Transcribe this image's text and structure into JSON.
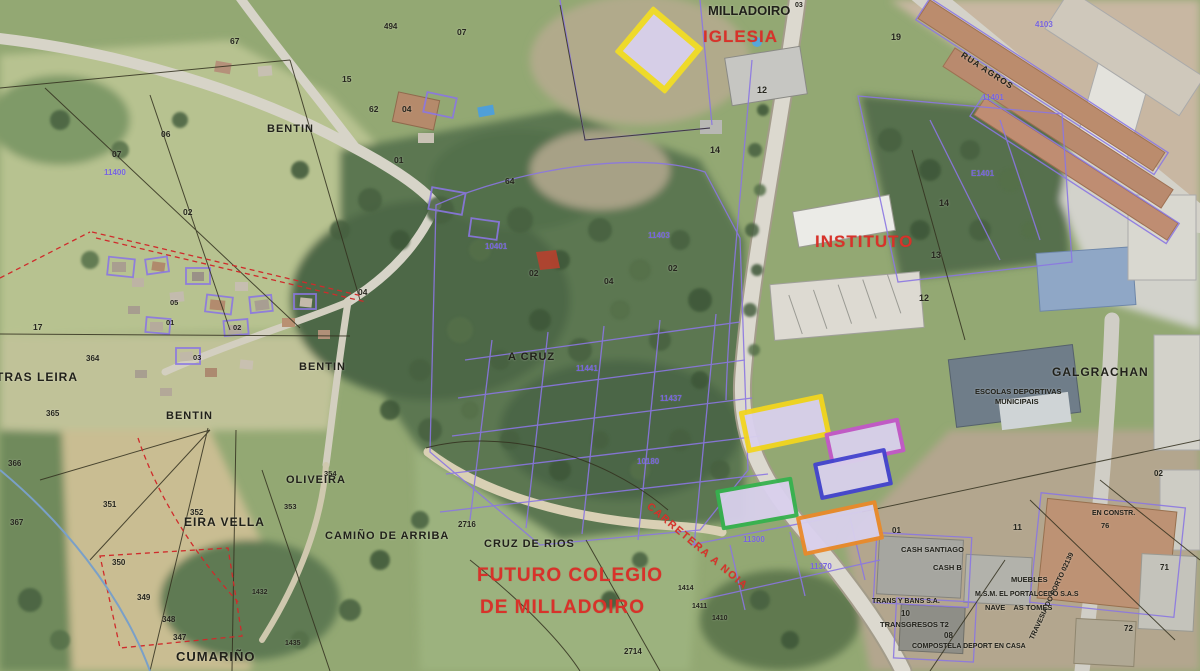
{
  "map": {
    "description": "Aerial cadastral map of Milladoiro with highlighted candidate parcels",
    "colors": {
      "highlight_fill": "#d9d0ec",
      "yellow": "#f2dd25",
      "magenta": "#c257c9",
      "blue": "#4343cf",
      "green": "#35b14f",
      "orange": "#e98a2b",
      "red_annotation": "#d8322a",
      "cadastral_purple": "#8b77e2"
    }
  },
  "highlight_parcels": [
    {
      "name": "highlighted-parcel-iglesia",
      "color": "#f2dd25",
      "fill": "#d9d0ec",
      "x": 626,
      "y": 20,
      "w": 54,
      "h": 48,
      "rot": 40,
      "bw": 6
    },
    {
      "name": "highlighted-parcel-yellow",
      "color": "#f2d51f",
      "fill": "#d9d0ec",
      "x": 742,
      "y": 402,
      "w": 76,
      "h": 33,
      "rot": -12,
      "bw": 5
    },
    {
      "name": "highlighted-parcel-magenta",
      "color": "#c257c9",
      "fill": "#d9d0ec",
      "x": 827,
      "y": 425,
      "w": 68,
      "h": 27,
      "rot": -12,
      "bw": 4
    },
    {
      "name": "highlighted-parcel-blue",
      "color": "#4343cf",
      "fill": "#d9d0ec",
      "x": 816,
      "y": 455,
      "w": 66,
      "h": 30,
      "rot": -12,
      "bw": 4
    },
    {
      "name": "highlighted-parcel-green",
      "color": "#35b14f",
      "fill": "#d9d0ec",
      "x": 718,
      "y": 483,
      "w": 70,
      "h": 33,
      "rot": -10,
      "bw": 4
    },
    {
      "name": "highlighted-parcel-orange",
      "color": "#e98a2b",
      "fill": "#d9d0ec",
      "x": 799,
      "y": 508,
      "w": 74,
      "h": 32,
      "rot": -12,
      "bw": 4
    }
  ],
  "labels": [
    {
      "name": "iglesia-label",
      "text": "IGLESIA",
      "x": 703,
      "y": 28,
      "cls": "red",
      "size": 17,
      "ls": 1
    },
    {
      "name": "instituto-label",
      "text": "INSTITUTO",
      "x": 815,
      "y": 233,
      "cls": "red",
      "size": 17,
      "ls": 1
    },
    {
      "name": "futuro-colegio-line1",
      "text": "FUTURO COLEGIO",
      "x": 477,
      "y": 566,
      "cls": "red",
      "size": 19,
      "ls": 1
    },
    {
      "name": "futuro-colegio-line2",
      "text": "DE MILLADOIRO",
      "x": 480,
      "y": 598,
      "cls": "red",
      "size": 19,
      "ls": 1
    },
    {
      "name": "carretera-road-label",
      "text": "CARRETERA A NOIA",
      "x": 648,
      "y": 500,
      "cls": "red",
      "size": 10.5,
      "rot": 40,
      "ls": 1.5
    },
    {
      "name": "milladoiro-label",
      "text": "MILLADOIRO",
      "x": 708,
      "y": 4,
      "cls": "black",
      "size": 13
    },
    {
      "name": "milladoiro-superscript",
      "text": "03",
      "x": 795,
      "y": 2,
      "cls": "black",
      "size": 7
    },
    {
      "name": "bentin-north-label",
      "text": "BENTIN",
      "x": 267,
      "y": 124,
      "cls": "black",
      "size": 11,
      "ls": 1
    },
    {
      "name": "bentin-mid-label",
      "text": "BENTIN",
      "x": 299,
      "y": 362,
      "cls": "black",
      "size": 11,
      "ls": 1
    },
    {
      "name": "bentin-south-label",
      "text": "BENTIN",
      "x": 166,
      "y": 411,
      "cls": "black",
      "size": 11,
      "ls": 1
    },
    {
      "name": "tras-leira-label",
      "text": "TRAS LEIRA",
      "x": -4,
      "y": 371,
      "cls": "black",
      "size": 12,
      "ls": 1
    },
    {
      "name": "eira-vella-label",
      "text": "EIRA VELLA",
      "x": 184,
      "y": 516,
      "cls": "black",
      "size": 12,
      "ls": 1
    },
    {
      "name": "oliveira-label",
      "text": "OLIVEIRA",
      "x": 286,
      "y": 475,
      "cls": "black",
      "size": 11,
      "ls": 1
    },
    {
      "name": "camino-de-arriba-label",
      "text": "CAMIÑO DE ARRIBA",
      "x": 325,
      "y": 531,
      "cls": "black",
      "size": 11,
      "ls": 1
    },
    {
      "name": "cruz-de-rios-label",
      "text": "CRUZ DE RIOS",
      "x": 484,
      "y": 539,
      "cls": "black",
      "size": 11,
      "ls": 1
    },
    {
      "name": "a-cruz-label",
      "text": "A CRUZ",
      "x": 508,
      "y": 352,
      "cls": "black",
      "size": 11,
      "ls": 1
    },
    {
      "name": "galgrachan-label",
      "text": "GALGRACHAN",
      "x": 1052,
      "y": 366,
      "cls": "black",
      "size": 12,
      "ls": 1
    },
    {
      "name": "escolas-deportivas-line1",
      "text": "ESCOLAS DEPORTIVAS",
      "x": 975,
      "y": 388,
      "cls": "black",
      "size": 7.5
    },
    {
      "name": "escolas-deportivas-line2",
      "text": "MUNICIPAIS",
      "x": 995,
      "y": 398,
      "cls": "black",
      "size": 7.5
    },
    {
      "name": "cumarino-label",
      "text": "CUMARIÑO",
      "x": 176,
      "y": 650,
      "cls": "black",
      "size": 13,
      "ls": 1
    },
    {
      "name": "cash-santiago-label",
      "text": "CASH SANTIAGO",
      "x": 901,
      "y": 546,
      "cls": "black",
      "size": 7.5
    },
    {
      "name": "cash-b-label",
      "text": "CASH B",
      "x": 933,
      "y": 564,
      "cls": "black",
      "size": 7.5
    },
    {
      "name": "muebles-label",
      "text": "MUEBLES",
      "x": 1011,
      "y": 576,
      "cls": "black",
      "size": 7.5
    },
    {
      "name": "portalcedo-label",
      "text": "M.S.M. EL PORTALCEDO S.A.S",
      "x": 975,
      "y": 591,
      "cls": "black",
      "size": 7
    },
    {
      "name": "nave-as-tomes-label",
      "text": "NAVE    AS TOMES",
      "x": 985,
      "y": 604,
      "cls": "black",
      "size": 7.5
    },
    {
      "name": "trans-y-bans-label",
      "text": "TRANS Y BANS S.A.",
      "x": 872,
      "y": 598,
      "cls": "black",
      "size": 7
    },
    {
      "name": "transgresos-label",
      "text": "TRANSGRESOS T2",
      "x": 880,
      "y": 621,
      "cls": "black",
      "size": 7.5
    },
    {
      "name": "compostela-deport-label",
      "text": "COMPOSTELA DEPORT EN CASA",
      "x": 912,
      "y": 643,
      "cls": "black",
      "size": 7
    },
    {
      "name": "travesia-road-label",
      "text": "TRAVESIA DO PORTO 02139",
      "x": 1032,
      "y": 636,
      "cls": "black",
      "size": 7,
      "rot": -65
    },
    {
      "name": "en-constr-label",
      "text": "EN CONSTR.",
      "x": 1092,
      "y": 510,
      "cls": "black",
      "size": 7
    },
    {
      "name": "parcel-number",
      "text": "76",
      "x": 1101,
      "y": 522,
      "cls": "num",
      "size": 7.5
    },
    {
      "name": "rua-agros-road-label",
      "text": "RUA AGROS",
      "x": 962,
      "y": 50,
      "cls": "black",
      "size": 8.5,
      "rot": 33,
      "ls": 1
    },
    {
      "name": "parcel-number",
      "text": "01",
      "x": 394,
      "y": 156,
      "cls": "num",
      "size": 8.5
    },
    {
      "name": "parcel-number",
      "text": "02",
      "x": 183,
      "y": 208,
      "cls": "num",
      "size": 8.5
    },
    {
      "name": "parcel-number",
      "text": "17",
      "x": 33,
      "y": 323,
      "cls": "num",
      "size": 8.5
    },
    {
      "name": "parcel-number",
      "text": "07",
      "x": 112,
      "y": 150,
      "cls": "num",
      "size": 8.5
    },
    {
      "name": "parcel-number",
      "text": "06",
      "x": 161,
      "y": 130,
      "cls": "num",
      "size": 8.5
    },
    {
      "name": "parcel-number",
      "text": "67",
      "x": 230,
      "y": 37,
      "cls": "num",
      "size": 8.5
    },
    {
      "name": "parcel-number",
      "text": "494",
      "x": 384,
      "y": 23,
      "cls": "num",
      "size": 8
    },
    {
      "name": "parcel-number",
      "text": "07",
      "x": 457,
      "y": 28,
      "cls": "num",
      "size": 8.5
    },
    {
      "name": "parcel-number",
      "text": "15",
      "x": 342,
      "y": 75,
      "cls": "num",
      "size": 8.5
    },
    {
      "name": "parcel-number",
      "text": "62",
      "x": 369,
      "y": 105,
      "cls": "num",
      "size": 8.5
    },
    {
      "name": "parcel-number",
      "text": "04",
      "x": 402,
      "y": 105,
      "cls": "num",
      "size": 8.5
    },
    {
      "name": "parcel-number",
      "text": "64",
      "x": 505,
      "y": 177,
      "cls": "num",
      "size": 8.5
    },
    {
      "name": "parcel-number",
      "text": "04",
      "x": 358,
      "y": 288,
      "cls": "num",
      "size": 8.5
    },
    {
      "name": "parcel-number",
      "text": "01",
      "x": 166,
      "y": 319,
      "cls": "num",
      "size": 7.5
    },
    {
      "name": "parcel-number",
      "text": "02",
      "x": 233,
      "y": 324,
      "cls": "num",
      "size": 7.5
    },
    {
      "name": "parcel-number",
      "text": "03",
      "x": 193,
      "y": 354,
      "cls": "num",
      "size": 7.5
    },
    {
      "name": "parcel-number",
      "text": "05",
      "x": 170,
      "y": 299,
      "cls": "num",
      "size": 7.5
    },
    {
      "name": "parcel-number",
      "text": "02",
      "x": 529,
      "y": 269,
      "cls": "num",
      "size": 8.5
    },
    {
      "name": "parcel-number",
      "text": "04",
      "x": 604,
      "y": 277,
      "cls": "num",
      "size": 8.5
    },
    {
      "name": "parcel-number",
      "text": "02",
      "x": 668,
      "y": 264,
      "cls": "num",
      "size": 8.5
    },
    {
      "name": "parcel-number",
      "text": "12",
      "x": 757,
      "y": 86,
      "cls": "num",
      "size": 9
    },
    {
      "name": "parcel-number",
      "text": "14",
      "x": 710,
      "y": 146,
      "cls": "num",
      "size": 9
    },
    {
      "name": "parcel-number",
      "text": "19",
      "x": 891,
      "y": 33,
      "cls": "num",
      "size": 9
    },
    {
      "name": "parcel-number",
      "text": "14",
      "x": 939,
      "y": 199,
      "cls": "num",
      "size": 9
    },
    {
      "name": "parcel-number",
      "text": "13",
      "x": 931,
      "y": 251,
      "cls": "num",
      "size": 9
    },
    {
      "name": "parcel-number",
      "text": "12",
      "x": 919,
      "y": 294,
      "cls": "num",
      "size": 9
    },
    {
      "name": "parcel-number",
      "text": "364",
      "x": 86,
      "y": 355,
      "cls": "num",
      "size": 8
    },
    {
      "name": "parcel-number",
      "text": "365",
      "x": 46,
      "y": 410,
      "cls": "num",
      "size": 8
    },
    {
      "name": "parcel-number",
      "text": "366",
      "x": 8,
      "y": 460,
      "cls": "num",
      "size": 8
    },
    {
      "name": "parcel-number",
      "text": "367",
      "x": 10,
      "y": 519,
      "cls": "num",
      "size": 8
    },
    {
      "name": "parcel-number",
      "text": "351",
      "x": 103,
      "y": 501,
      "cls": "num",
      "size": 8
    },
    {
      "name": "parcel-number",
      "text": "352",
      "x": 190,
      "y": 509,
      "cls": "num",
      "size": 8
    },
    {
      "name": "parcel-number",
      "text": "350",
      "x": 112,
      "y": 559,
      "cls": "num",
      "size": 8
    },
    {
      "name": "parcel-number",
      "text": "349",
      "x": 137,
      "y": 594,
      "cls": "num",
      "size": 8
    },
    {
      "name": "parcel-number",
      "text": "348",
      "x": 162,
      "y": 616,
      "cls": "num",
      "size": 8
    },
    {
      "name": "parcel-number",
      "text": "347",
      "x": 173,
      "y": 634,
      "cls": "num",
      "size": 8
    },
    {
      "name": "parcel-number",
      "text": "354",
      "x": 324,
      "y": 470,
      "cls": "num",
      "size": 7.5
    },
    {
      "name": "parcel-number",
      "text": "353",
      "x": 284,
      "y": 503,
      "cls": "num",
      "size": 7.5
    },
    {
      "name": "parcel-number",
      "text": "2716",
      "x": 458,
      "y": 521,
      "cls": "num",
      "size": 8
    },
    {
      "name": "parcel-number",
      "text": "2714",
      "x": 624,
      "y": 648,
      "cls": "num",
      "size": 8
    },
    {
      "name": "parcel-number",
      "text": "1414",
      "x": 678,
      "y": 585,
      "cls": "num",
      "size": 7
    },
    {
      "name": "parcel-number",
      "text": "1411",
      "x": 692,
      "y": 603,
      "cls": "num",
      "size": 7
    },
    {
      "name": "parcel-number",
      "text": "1410",
      "x": 712,
      "y": 615,
      "cls": "num",
      "size": 7
    },
    {
      "name": "parcel-number",
      "text": "1432",
      "x": 252,
      "y": 589,
      "cls": "num",
      "size": 7
    },
    {
      "name": "parcel-number",
      "text": "1435",
      "x": 285,
      "y": 640,
      "cls": "num",
      "size": 7
    },
    {
      "name": "parcel-number",
      "text": "11",
      "x": 1013,
      "y": 523,
      "cls": "num",
      "size": 8.5
    },
    {
      "name": "parcel-number",
      "text": "01",
      "x": 892,
      "y": 527,
      "cls": "num",
      "size": 8
    },
    {
      "name": "parcel-number",
      "text": "10",
      "x": 901,
      "y": 610,
      "cls": "num",
      "size": 8
    },
    {
      "name": "parcel-number",
      "text": "08",
      "x": 944,
      "y": 632,
      "cls": "num",
      "size": 8
    },
    {
      "name": "parcel-number",
      "text": "72",
      "x": 1124,
      "y": 625,
      "cls": "num",
      "size": 8
    },
    {
      "name": "parcel-number",
      "text": "71",
      "x": 1160,
      "y": 564,
      "cls": "num",
      "size": 8
    },
    {
      "name": "parcel-number",
      "text": "02",
      "x": 1154,
      "y": 470,
      "cls": "num",
      "size": 8
    },
    {
      "name": "cadastral-ref",
      "text": "11400",
      "x": 104,
      "y": 169,
      "cls": "purple",
      "size": 8
    },
    {
      "name": "cadastral-ref",
      "text": "10401",
      "x": 485,
      "y": 243,
      "cls": "purple",
      "size": 8
    },
    {
      "name": "cadastral-ref",
      "text": "11403",
      "x": 648,
      "y": 232,
      "cls": "purple",
      "size": 8
    },
    {
      "name": "cadastral-ref",
      "text": "11441",
      "x": 576,
      "y": 365,
      "cls": "purple",
      "size": 8
    },
    {
      "name": "cadastral-ref",
      "text": "11437",
      "x": 660,
      "y": 395,
      "cls": "purple",
      "size": 8
    },
    {
      "name": "cadastral-ref",
      "text": "10180",
      "x": 637,
      "y": 458,
      "cls": "purple",
      "size": 8
    },
    {
      "name": "cadastral-ref",
      "text": "11300",
      "x": 743,
      "y": 536,
      "cls": "purple",
      "size": 8
    },
    {
      "name": "cadastral-ref",
      "text": "11370",
      "x": 810,
      "y": 563,
      "cls": "purple",
      "size": 8
    },
    {
      "name": "cadastral-ref",
      "text": "E1401",
      "x": 971,
      "y": 170,
      "cls": "purple",
      "size": 8
    },
    {
      "name": "cadastral-ref",
      "text": "11401",
      "x": 982,
      "y": 94,
      "cls": "purple",
      "size": 8
    },
    {
      "name": "cadastral-ref",
      "text": "4103",
      "x": 1035,
      "y": 21,
      "cls": "purple",
      "size": 8
    }
  ]
}
